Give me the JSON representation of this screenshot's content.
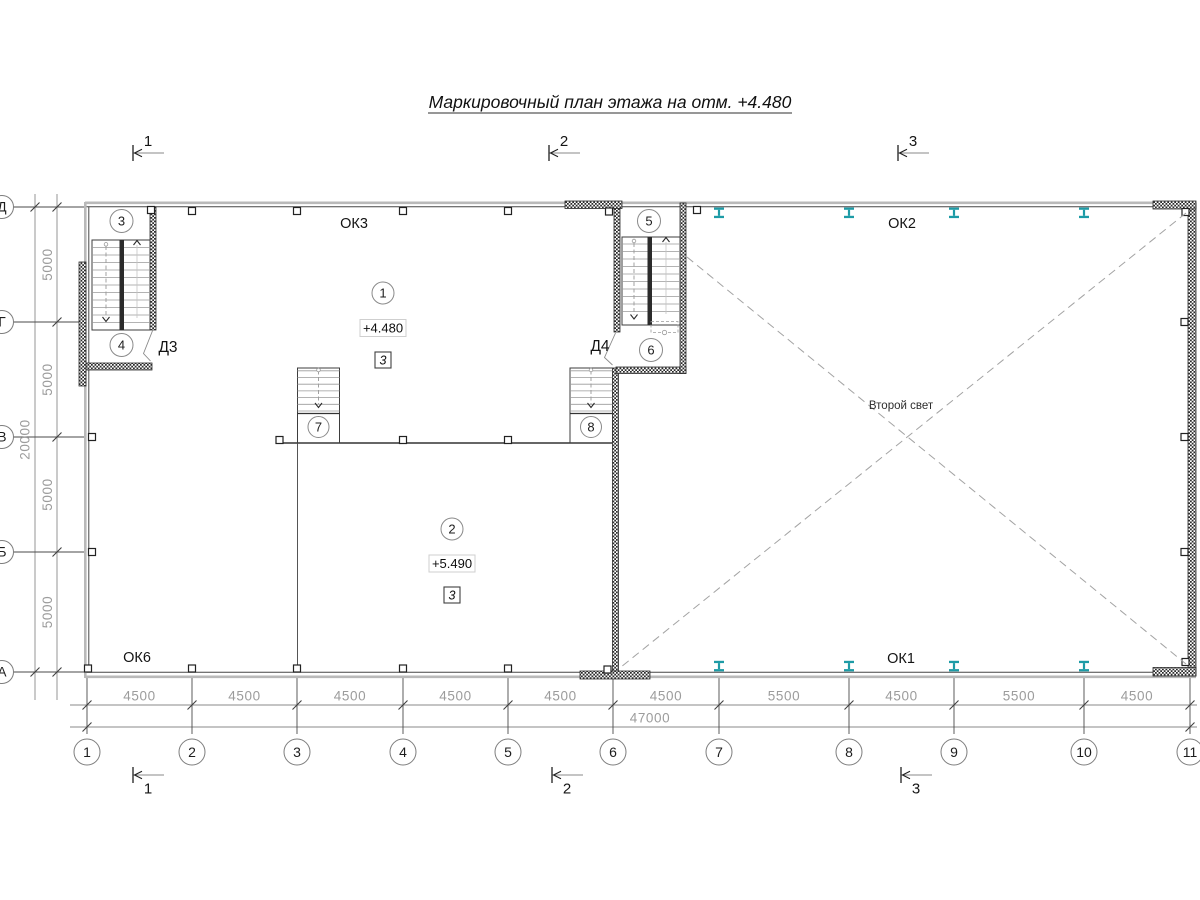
{
  "title": "Маркировочный план этажа на отм. +4.480",
  "colors": {
    "steel_column": "#1d9ba6",
    "drawing_line": "#333333",
    "dimension_text": "#9c9c9c"
  },
  "plan": {
    "grid_columns": [
      "1",
      "2",
      "3",
      "4",
      "5",
      "6",
      "7",
      "8",
      "9",
      "10",
      "11"
    ],
    "grid_rows": [
      "Д",
      "Г",
      "В",
      "Б",
      "А"
    ],
    "dim_bottom_segments": [
      "4500",
      "4500",
      "4500",
      "4500",
      "4500",
      "4500",
      "5500",
      "4500",
      "5500",
      "4500"
    ],
    "dim_bottom_total": "47000",
    "dim_left_segments": [
      "5000",
      "5000",
      "5000",
      "5000"
    ],
    "dim_left_total": "20000",
    "section_marks": [
      "1",
      "2",
      "3"
    ],
    "windows": {
      "top_left": "ОК3",
      "top_right": "ОК2",
      "bottom_left": "ОК6",
      "bottom_right": "ОК1"
    },
    "doors": {
      "left": "Д3",
      "middle": "Д4"
    },
    "rooms": [
      {
        "number": "1",
        "elevation": "+4.480",
        "type_mark": "3"
      },
      {
        "number": "2",
        "elevation": "+5.490",
        "type_mark": "3"
      }
    ],
    "stair_marks": [
      "3",
      "4",
      "5",
      "6",
      "7",
      "8"
    ],
    "annotation_second_light": "Второй свет"
  }
}
